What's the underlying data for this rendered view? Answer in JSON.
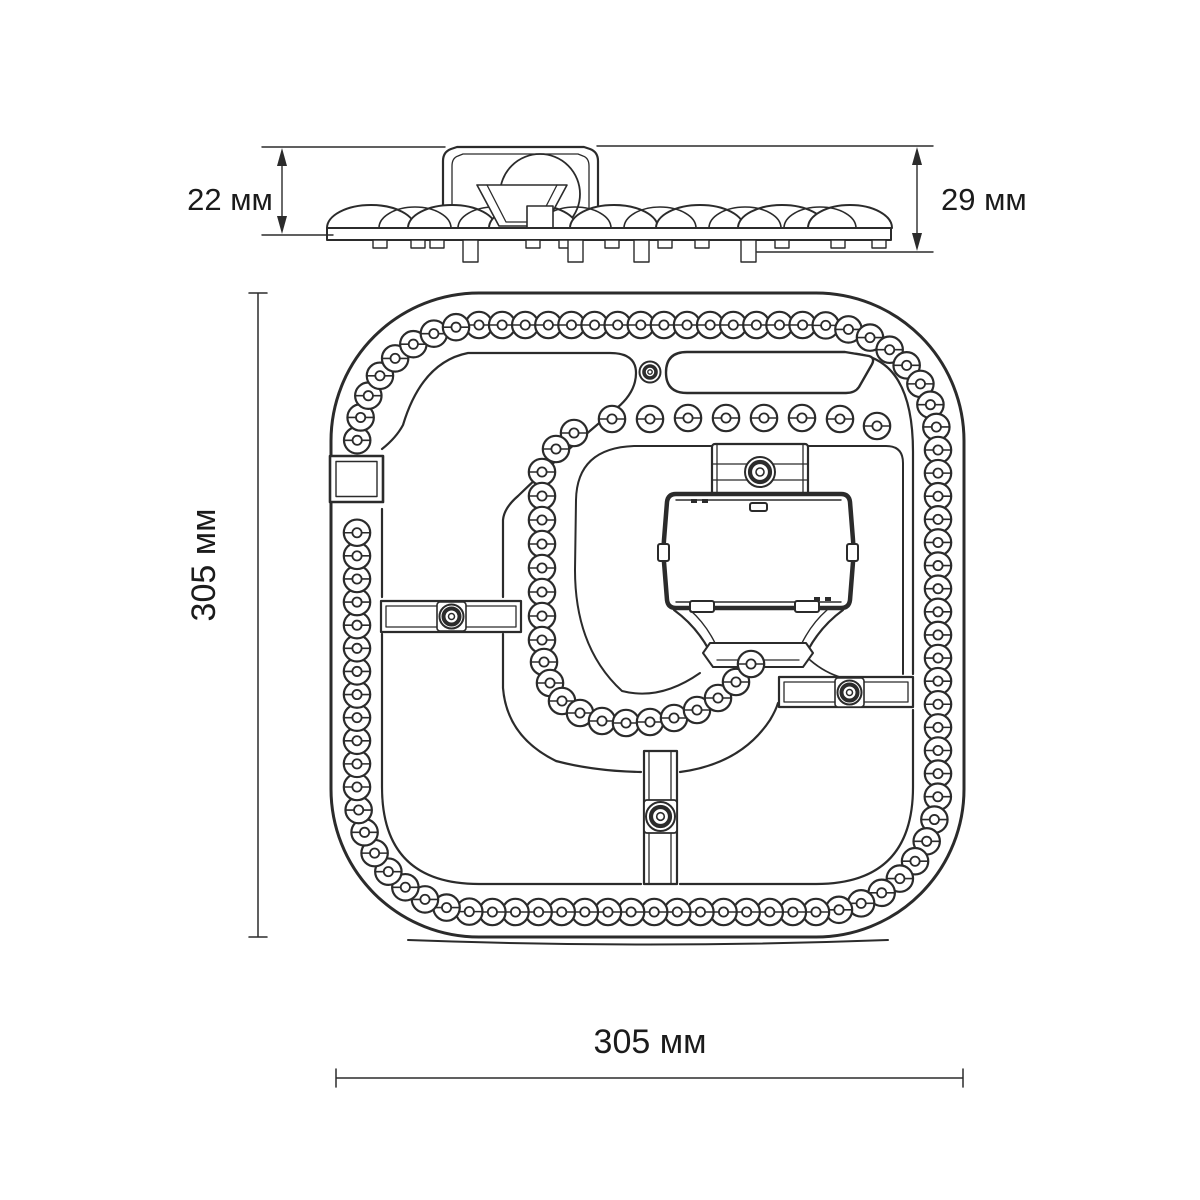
{
  "drawing": {
    "labels": {
      "side_height_small": "22 мм",
      "side_height_total": "29 мм",
      "plan_height": "305 мм",
      "plan_width": "305 мм"
    },
    "colors": {
      "ink": "#2b2b2b",
      "background": "#ffffff"
    }
  }
}
